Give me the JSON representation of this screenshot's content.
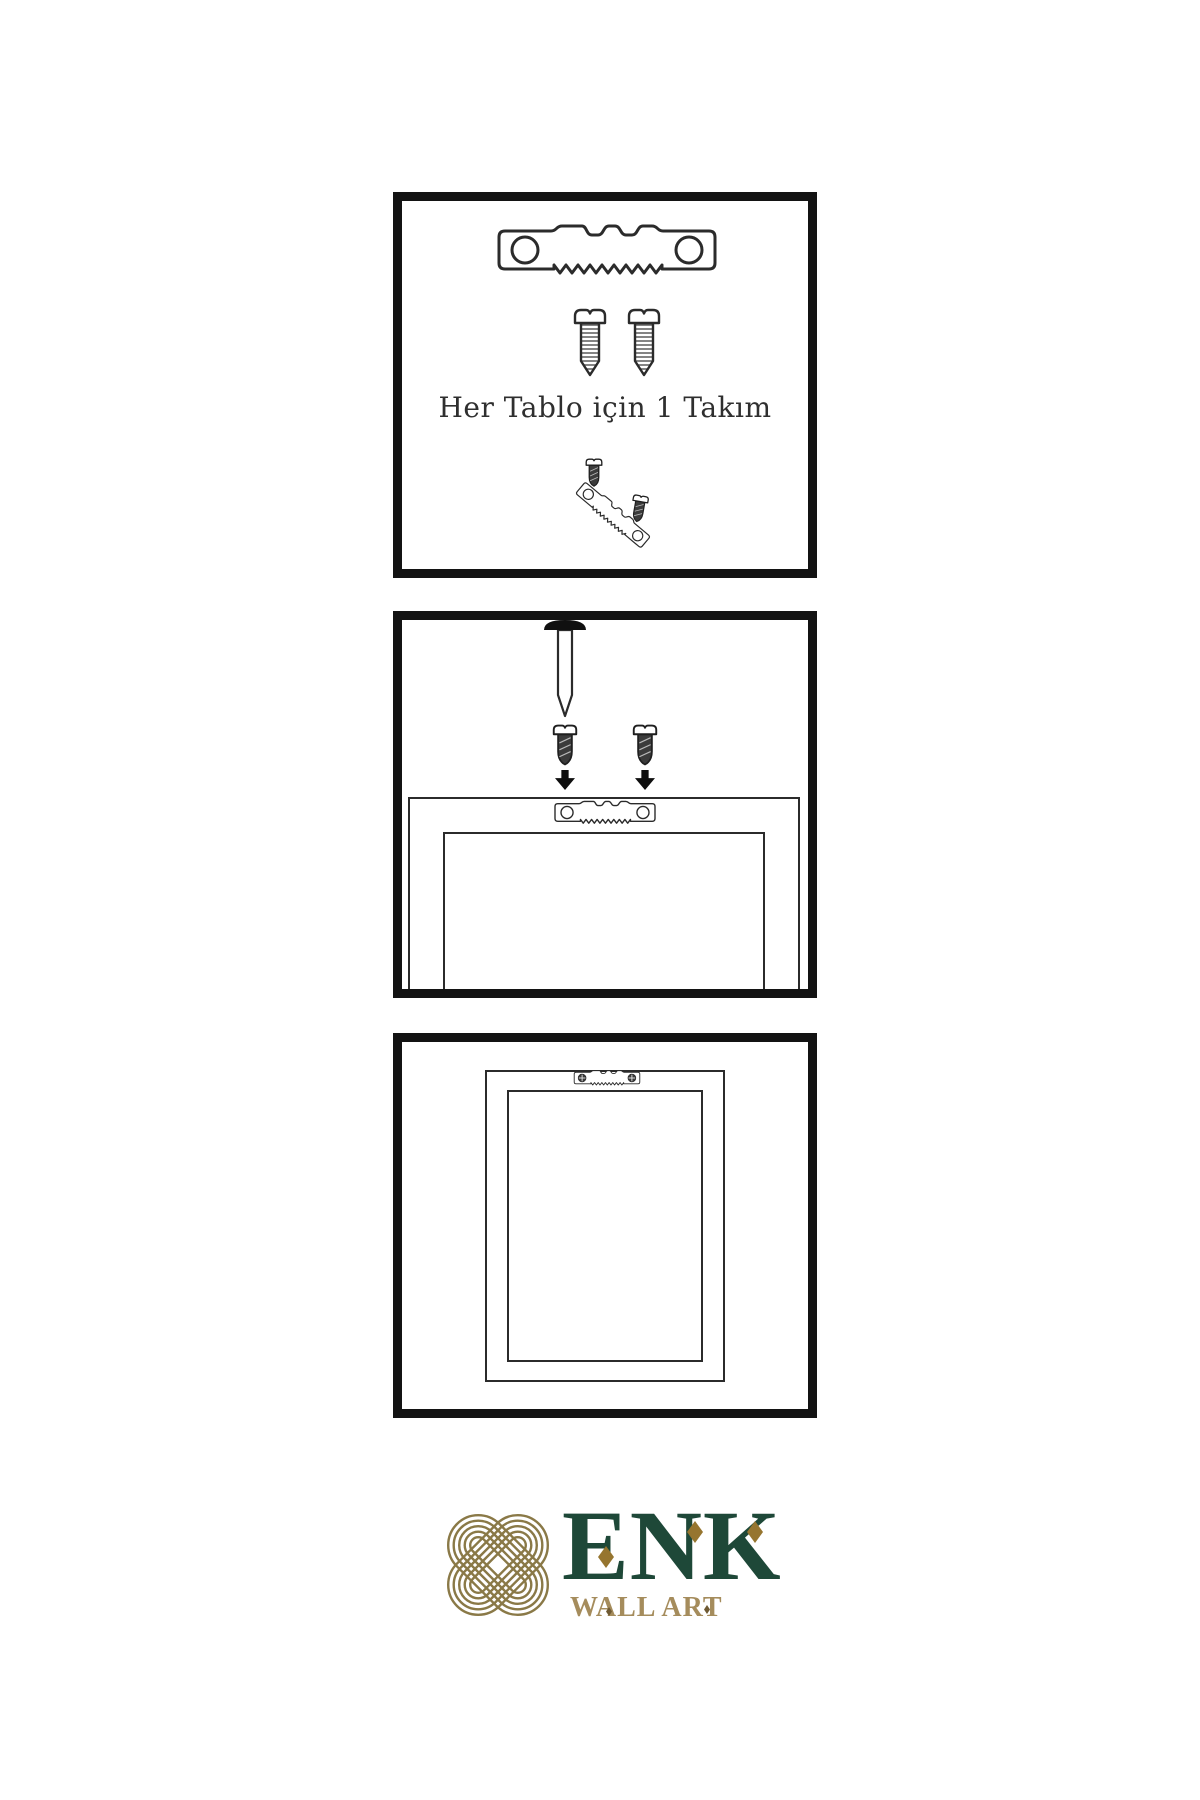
{
  "page": {
    "background_color": "#ffffff",
    "line_color": "#2b2b2b",
    "panel_border_color": "#131313"
  },
  "steps": [
    {
      "name": "hardware-set",
      "caption": "Her Tablo için 1 Takım",
      "parts": [
        "sawtooth-hanger",
        "screw",
        "screw",
        "screw",
        "sawtooth-hanger-tilted",
        "screw"
      ]
    },
    {
      "name": "wall-mounting",
      "caption": "",
      "parts": [
        "wall-nail",
        "screw",
        "screw",
        "down-arrow",
        "down-arrow",
        "frame-back",
        "sawtooth-hanger"
      ]
    },
    {
      "name": "frame-hung",
      "caption": "",
      "parts": [
        "frame-back",
        "sawtooth-hanger-installed"
      ]
    }
  ],
  "logo": {
    "brand": "ENK",
    "tagline": "WALL ART",
    "brand_color": "#1e4838",
    "tagline_color": "#a58c5c",
    "knot_color": "#8a7947",
    "diamond_color": "#96752f"
  }
}
